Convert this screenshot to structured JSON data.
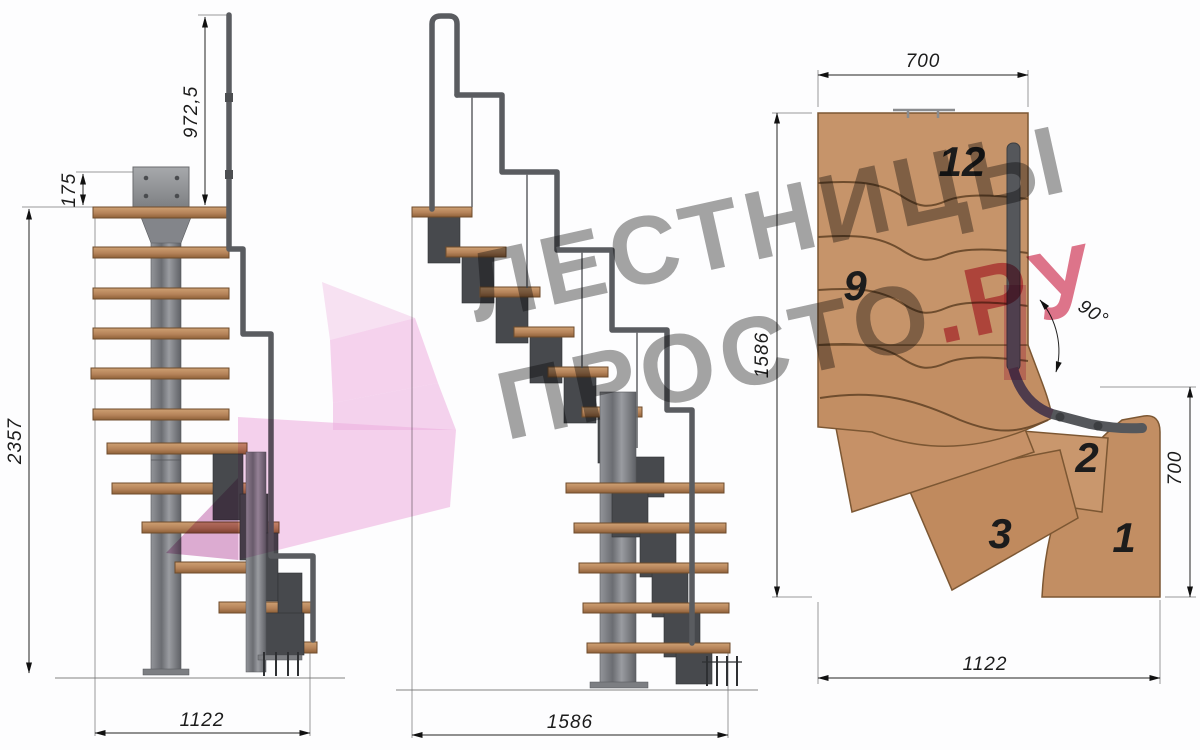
{
  "drawing": {
    "title": "modular-staircase-technical-drawing",
    "watermark": {
      "line1": "ЛЕСТНИЦЫ",
      "line2_prefix": "ПРОСТО",
      "line2_suffix": ".РУ",
      "text_color": "#8e8e8e",
      "accent_color": "#d8536f",
      "arrow_color": "#efaede"
    },
    "front_view": {
      "dim_handrail_height": "972,5",
      "dim_plate_offset": "175",
      "dim_total_height": "2357",
      "dim_width": "1122"
    },
    "side_view": {
      "dim_depth": "1586"
    },
    "plan_view": {
      "dim_top_width": "700",
      "dim_left_depth": "1586",
      "dim_right_depth": "700",
      "dim_bottom_width": "1122",
      "dim_turn_angle": "90°",
      "tread_numbers": {
        "n12": "12",
        "n9": "9",
        "n3": "3",
        "n2": "2",
        "n1": "1"
      }
    },
    "colors": {
      "wood_light": "#c59469",
      "wood_dark": "#9a6a41",
      "steel": "#74767a",
      "steel_dark": "#45474a",
      "dimension": "#222222"
    }
  }
}
